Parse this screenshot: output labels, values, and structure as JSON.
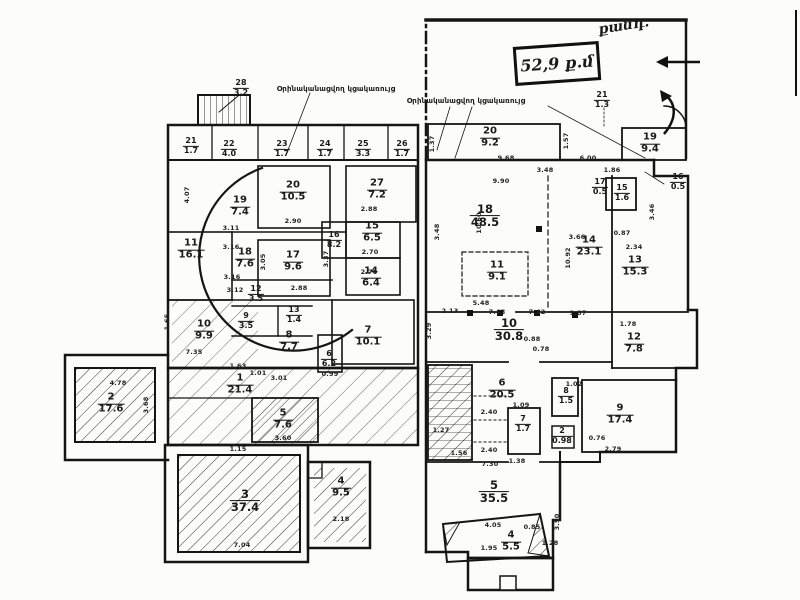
{
  "page": {
    "background": "#fcfcfa",
    "ink": "#1a1a1a"
  },
  "annotations": {
    "stamp": "52,9 ք.մ",
    "handwritten_note": "քանդ.",
    "annex_note": "Օրինականացվող կցակառույց"
  },
  "plans": [
    {
      "id": "left",
      "name": "plan-left",
      "notes": [
        {
          "t": "Օրինականացվող կցակառույց",
          "x": 336,
          "y": 89
        }
      ],
      "rooms": [
        {
          "no": "28",
          "area": "3.2",
          "x": 241,
          "y": 88,
          "sz": "s"
        },
        {
          "no": "21",
          "area": "1.7",
          "x": 191,
          "y": 146,
          "sz": "s"
        },
        {
          "no": "22",
          "area": "4.0",
          "x": 229,
          "y": 149,
          "sz": "s"
        },
        {
          "no": "23",
          "area": "1.7",
          "x": 282,
          "y": 149,
          "sz": "s"
        },
        {
          "no": "24",
          "area": "1.7",
          "x": 325,
          "y": 149,
          "sz": "s"
        },
        {
          "no": "25",
          "area": "3.3",
          "x": 363,
          "y": 149,
          "sz": "s"
        },
        {
          "no": "26",
          "area": "1.7",
          "x": 402,
          "y": 149,
          "sz": "s"
        },
        {
          "no": "27",
          "area": "7.2",
          "x": 377,
          "y": 190
        },
        {
          "no": "20",
          "area": "10.5",
          "x": 293,
          "y": 192
        },
        {
          "no": "19",
          "area": "7.4",
          "x": 240,
          "y": 207
        },
        {
          "no": "11",
          "area": "16.1",
          "x": 191,
          "y": 250
        },
        {
          "no": "16",
          "area": "8.2",
          "x": 334,
          "y": 240,
          "sz": "s"
        },
        {
          "no": "15",
          "area": "6.5",
          "x": 372,
          "y": 233
        },
        {
          "no": "18",
          "area": "7.6",
          "x": 245,
          "y": 259
        },
        {
          "no": "17",
          "area": "9.6",
          "x": 293,
          "y": 262
        },
        {
          "no": "14",
          "area": "6.4",
          "x": 371,
          "y": 278
        },
        {
          "no": "12",
          "area": "3.5",
          "x": 256,
          "y": 294,
          "sz": "s"
        },
        {
          "no": "13",
          "area": "1.4",
          "x": 294,
          "y": 315,
          "sz": "s"
        },
        {
          "no": "9",
          "area": "3.5",
          "x": 246,
          "y": 321,
          "sz": "s"
        },
        {
          "no": "10",
          "area": "9.9",
          "x": 204,
          "y": 331
        },
        {
          "no": "8",
          "area": "7.7",
          "x": 289,
          "y": 342
        },
        {
          "no": "7",
          "area": "10.1",
          "x": 368,
          "y": 337
        },
        {
          "no": "6",
          "area": "6.2",
          "x": 329,
          "y": 359,
          "sz": "s"
        },
        {
          "no": "1",
          "area": "21.4",
          "x": 240,
          "y": 385
        },
        {
          "no": "2",
          "area": "17.6",
          "x": 111,
          "y": 404
        },
        {
          "no": "5",
          "area": "7.6",
          "x": 283,
          "y": 420
        },
        {
          "no": "3",
          "area": "37.4",
          "x": 245,
          "y": 501,
          "sz": "l"
        },
        {
          "no": "4",
          "area": "9.5",
          "x": 341,
          "y": 488
        }
      ],
      "dims": [
        {
          "t": "4.07",
          "x": 187,
          "y": 195,
          "r": "v"
        },
        {
          "t": "1.65",
          "x": 167,
          "y": 322,
          "r": "v"
        },
        {
          "t": "3.11",
          "x": 231,
          "y": 228
        },
        {
          "t": "3.16",
          "x": 231,
          "y": 247
        },
        {
          "t": "3.16",
          "x": 232,
          "y": 277
        },
        {
          "t": "3.12",
          "x": 235,
          "y": 290
        },
        {
          "t": "2.90",
          "x": 293,
          "y": 221
        },
        {
          "t": "2.88",
          "x": 369,
          "y": 209
        },
        {
          "t": "2.70",
          "x": 370,
          "y": 252
        },
        {
          "t": "2.70",
          "x": 369,
          "y": 272
        },
        {
          "t": "2.88",
          "x": 299,
          "y": 288
        },
        {
          "t": "3.37",
          "x": 326,
          "y": 259,
          "r": "v"
        },
        {
          "t": "3.05",
          "x": 263,
          "y": 262,
          "r": "v"
        },
        {
          "t": "7.35",
          "x": 194,
          "y": 352
        },
        {
          "t": "1.63",
          "x": 238,
          "y": 366
        },
        {
          "t": "1.01",
          "x": 258,
          "y": 373
        },
        {
          "t": "3.01",
          "x": 279,
          "y": 378
        },
        {
          "t": "0.99",
          "x": 330,
          "y": 374
        },
        {
          "t": "4.78",
          "x": 118,
          "y": 383
        },
        {
          "t": "3.68",
          "x": 146,
          "y": 405,
          "r": "v"
        },
        {
          "t": "3.60",
          "x": 283,
          "y": 438
        },
        {
          "t": "1.15",
          "x": 238,
          "y": 449
        },
        {
          "t": "7.04",
          "x": 242,
          "y": 545
        },
        {
          "t": "2.18",
          "x": 341,
          "y": 519
        }
      ]
    },
    {
      "id": "right",
      "name": "plan-right",
      "notes": [
        {
          "t": "Օրինականացվող կցակառույց",
          "x": 466,
          "y": 101
        }
      ],
      "rooms": [
        {
          "no": "20",
          "area": "9.2",
          "x": 490,
          "y": 138
        },
        {
          "no": "21",
          "area": "1.3",
          "x": 602,
          "y": 100,
          "sz": "s"
        },
        {
          "no": "19",
          "area": "9.4",
          "x": 650,
          "y": 144
        },
        {
          "no": "17",
          "area": "0.5",
          "x": 600,
          "y": 187,
          "sz": "s"
        },
        {
          "no": "15",
          "area": "1.6",
          "x": 622,
          "y": 193,
          "sz": "s"
        },
        {
          "no": "16",
          "area": "0.5",
          "x": 678,
          "y": 182,
          "sz": "s"
        },
        {
          "no": "18",
          "area": "48.5",
          "x": 485,
          "y": 216,
          "sz": "l"
        },
        {
          "no": "14",
          "area": "23.1",
          "x": 589,
          "y": 247
        },
        {
          "no": "13",
          "area": "15.3",
          "x": 635,
          "y": 267
        },
        {
          "no": "11",
          "area": "9.1",
          "x": 497,
          "y": 272
        },
        {
          "no": "10",
          "area": "30.8",
          "x": 509,
          "y": 330,
          "sz": "l"
        },
        {
          "no": "12",
          "area": "7.8",
          "x": 634,
          "y": 344
        },
        {
          "no": "6",
          "area": "20.5",
          "x": 502,
          "y": 390
        },
        {
          "no": "8",
          "area": "1.5",
          "x": 566,
          "y": 396,
          "sz": "s"
        },
        {
          "no": "7",
          "area": "1.7",
          "x": 523,
          "y": 424,
          "sz": "s"
        },
        {
          "no": "9",
          "area": "17.4",
          "x": 620,
          "y": 415
        },
        {
          "no": "2",
          "area": "0.98",
          "x": 562,
          "y": 436,
          "sz": "s"
        },
        {
          "no": "5",
          "area": "35.5",
          "x": 494,
          "y": 492,
          "sz": "l"
        },
        {
          "no": "4",
          "area": "5.5",
          "x": 511,
          "y": 542
        }
      ],
      "dims": [
        {
          "t": "1.37",
          "x": 432,
          "y": 144,
          "r": "v"
        },
        {
          "t": "9.68",
          "x": 506,
          "y": 158
        },
        {
          "t": "6.00",
          "x": 588,
          "y": 158
        },
        {
          "t": "1.57",
          "x": 566,
          "y": 141,
          "r": "v"
        },
        {
          "t": "9.90",
          "x": 501,
          "y": 181
        },
        {
          "t": "3.48",
          "x": 545,
          "y": 170
        },
        {
          "t": "3.48",
          "x": 437,
          "y": 232,
          "r": "v"
        },
        {
          "t": "10.60",
          "x": 479,
          "y": 223,
          "r": "v"
        },
        {
          "t": "3.66",
          "x": 577,
          "y": 237
        },
        {
          "t": "2.34",
          "x": 634,
          "y": 247
        },
        {
          "t": "1.86",
          "x": 612,
          "y": 170
        },
        {
          "t": "0.87",
          "x": 622,
          "y": 233
        },
        {
          "t": "3.46",
          "x": 652,
          "y": 212,
          "r": "v"
        },
        {
          "t": "10.92",
          "x": 568,
          "y": 258,
          "r": "v"
        },
        {
          "t": "2.13",
          "x": 450,
          "y": 311
        },
        {
          "t": "5.48",
          "x": 481,
          "y": 303
        },
        {
          "t": "7.43",
          "x": 497,
          "y": 312
        },
        {
          "t": "7.42",
          "x": 537,
          "y": 312
        },
        {
          "t": "1.87",
          "x": 578,
          "y": 313
        },
        {
          "t": "3.29",
          "x": 429,
          "y": 331,
          "r": "v"
        },
        {
          "t": "0.88",
          "x": 532,
          "y": 339
        },
        {
          "t": "0.78",
          "x": 541,
          "y": 349
        },
        {
          "t": "1.78",
          "x": 628,
          "y": 324
        },
        {
          "t": "1.02",
          "x": 574,
          "y": 384
        },
        {
          "t": "1.09",
          "x": 521,
          "y": 405
        },
        {
          "t": "2.40",
          "x": 489,
          "y": 412
        },
        {
          "t": "2.40",
          "x": 489,
          "y": 450
        },
        {
          "t": "7.30",
          "x": 490,
          "y": 464
        },
        {
          "t": "1.38",
          "x": 517,
          "y": 461
        },
        {
          "t": "1.27",
          "x": 441,
          "y": 430
        },
        {
          "t": "1.56",
          "x": 459,
          "y": 453
        },
        {
          "t": "0.76",
          "x": 597,
          "y": 438
        },
        {
          "t": "2.79",
          "x": 613,
          "y": 449
        },
        {
          "t": "4.05",
          "x": 493,
          "y": 525
        },
        {
          "t": "1.95",
          "x": 489,
          "y": 548
        },
        {
          "t": "0.85",
          "x": 532,
          "y": 527
        },
        {
          "t": "1.28",
          "x": 550,
          "y": 543
        },
        {
          "t": "3.50",
          "x": 557,
          "y": 522,
          "r": "v"
        }
      ]
    }
  ]
}
